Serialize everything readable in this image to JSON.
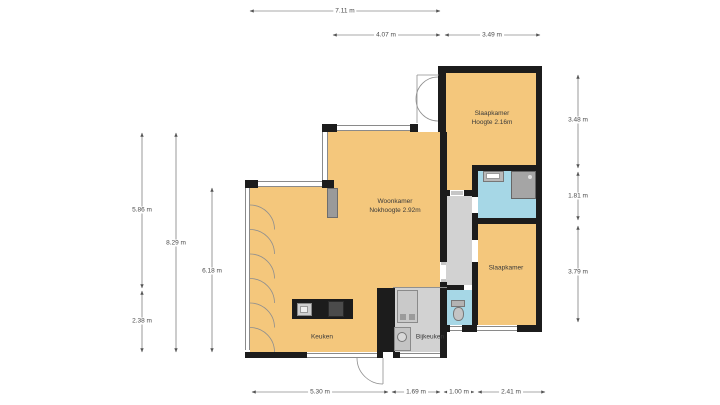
{
  "rooms": [
    {
      "label": "Woonkamer",
      "sublabel": "Nokhoogte 2.92m"
    },
    {
      "label": "Slaapkamer",
      "sublabel": "Hoogte 2.16m"
    },
    {
      "label": "Slaapkamer",
      "sublabel": ""
    },
    {
      "label": "Keuken",
      "sublabel": ""
    },
    {
      "label": "Bijkeuken",
      "sublabel": ""
    }
  ],
  "dimensions": {
    "top": [
      {
        "label": "7.11 m"
      },
      {
        "label": "4.07 m"
      },
      {
        "label": "3.49 m"
      }
    ],
    "left": [
      {
        "label": "5.86 m"
      },
      {
        "label": "8.29 m"
      },
      {
        "label": "2.38 m"
      },
      {
        "label": "6.18 m"
      }
    ],
    "right": [
      {
        "label": "3.48 m"
      },
      {
        "label": "1.81 m"
      },
      {
        "label": "3.79 m"
      }
    ],
    "bottom": [
      {
        "label": "5.30 m"
      },
      {
        "label": "1.69 m"
      },
      {
        "label": "1.00 m"
      },
      {
        "label": "2.41 m"
      }
    ]
  },
  "colors": {
    "floor": "#f4c77c",
    "wall": "#1c1c1c",
    "wet_room": "#a6d7e6",
    "utility": "#d2d2d2",
    "dimension_text": "#4a4a4a"
  }
}
